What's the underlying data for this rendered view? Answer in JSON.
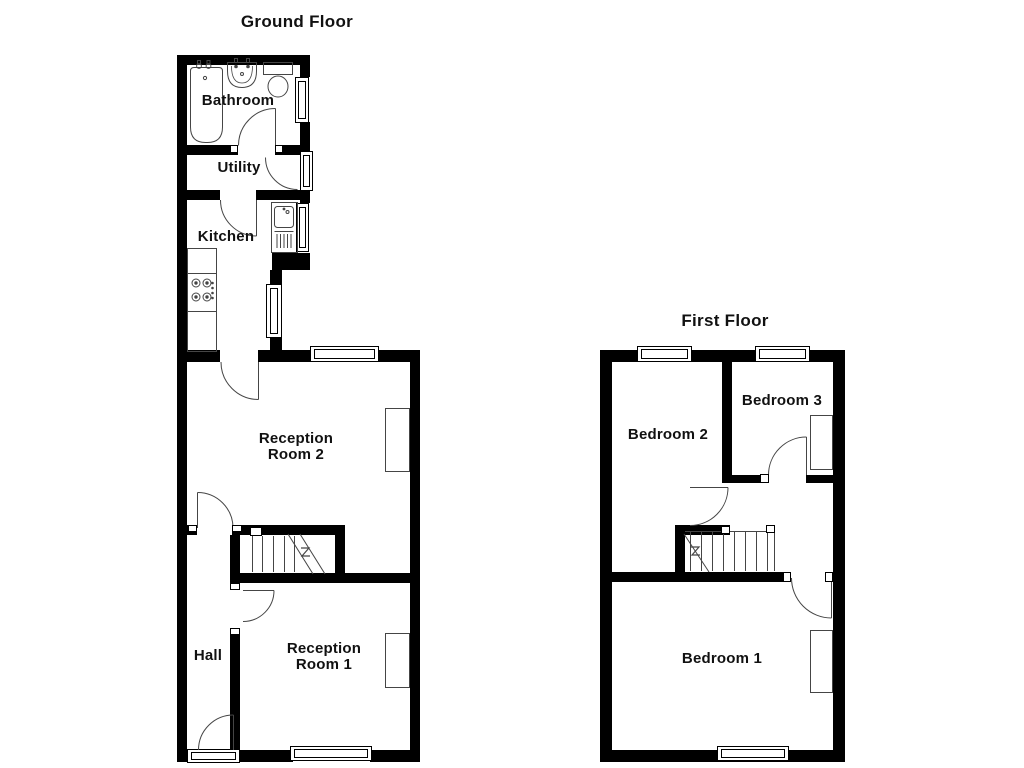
{
  "ground_floor": {
    "title": "Ground Floor",
    "rooms": {
      "bathroom": "Bathroom",
      "utility": "Utility",
      "kitchen": "Kitchen",
      "reception2": "Reception Room 2",
      "hall": "Hall",
      "reception1": "Reception Room 1"
    }
  },
  "first_floor": {
    "title": "First Floor",
    "rooms": {
      "bedroom2": "Bedroom 2",
      "bedroom3": "Bedroom 3",
      "bedroom1": "Bedroom 1"
    }
  },
  "colors": {
    "wall": "#000000",
    "detail_line": "#454545",
    "background": "#ffffff",
    "text": "#111111"
  }
}
